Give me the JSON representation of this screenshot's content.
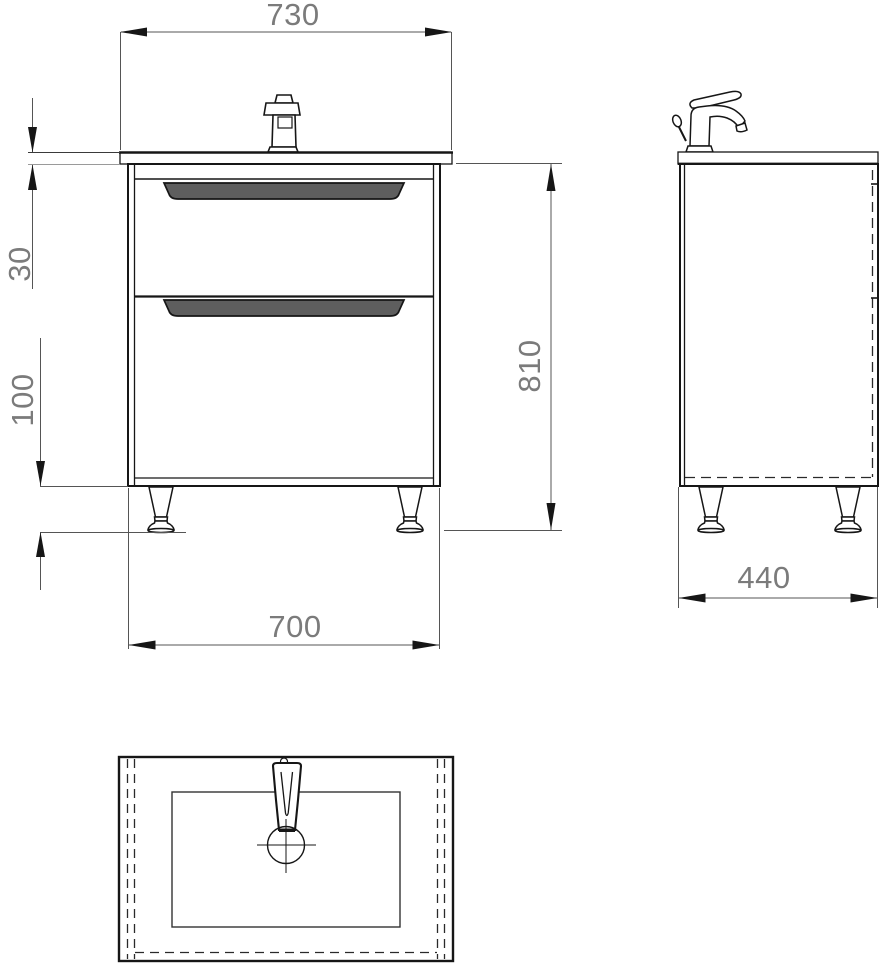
{
  "drawing": {
    "subject": "vanity-unit-with-washbasin-dimension-drawing",
    "dimensions": {
      "overall_width": "730",
      "worktop_thickness": "30",
      "leg_height": "100",
      "overall_height": "810",
      "cabinet_width": "700",
      "depth": "440"
    },
    "colors": {
      "line": "#161616",
      "dim_line": "#555555",
      "dim_text": "#7b7b7b",
      "gray_ext_line": "#9a9a9a",
      "handle_fill": "#5e5e5e",
      "background": "#ffffff"
    }
  }
}
